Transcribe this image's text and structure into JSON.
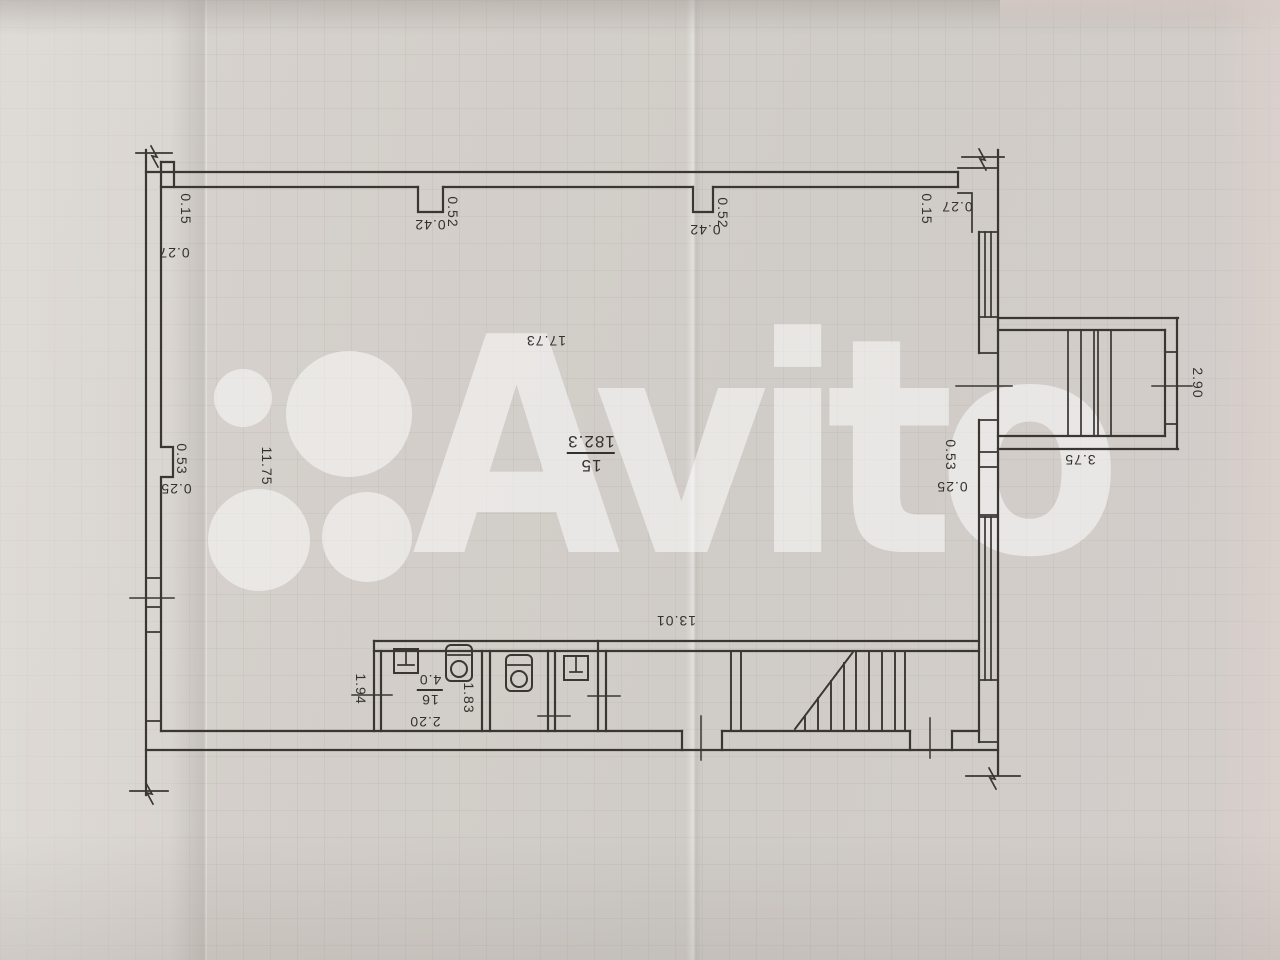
{
  "watermark": {
    "brand": "Avito"
  },
  "plan": {
    "rooms": [
      {
        "number": "15",
        "area": "182.3"
      },
      {
        "number": "16",
        "area": "4.0"
      }
    ],
    "dims": {
      "left_top_h": "0.15",
      "left_top_v": "0.27",
      "pilaster1_w": "0.42",
      "pilaster1_d": "0.52",
      "pilaster2_w": "0.42",
      "pilaster2_d": "0.52",
      "right_top_h": "0.15",
      "right_top_v": "0.27",
      "room15_width": "17.73",
      "room15_depth": "11.75",
      "left_niche_w": "0.53",
      "left_niche_d": "0.25",
      "right_niche_w": "0.53",
      "right_niche_d": "0.25",
      "stairwell_w": "3.75",
      "stairwell_d": "2.90",
      "bottom_width": "13.01",
      "wc_entry": "1.94",
      "wc_width": "2.20",
      "wc_depth": "1.83"
    }
  }
}
